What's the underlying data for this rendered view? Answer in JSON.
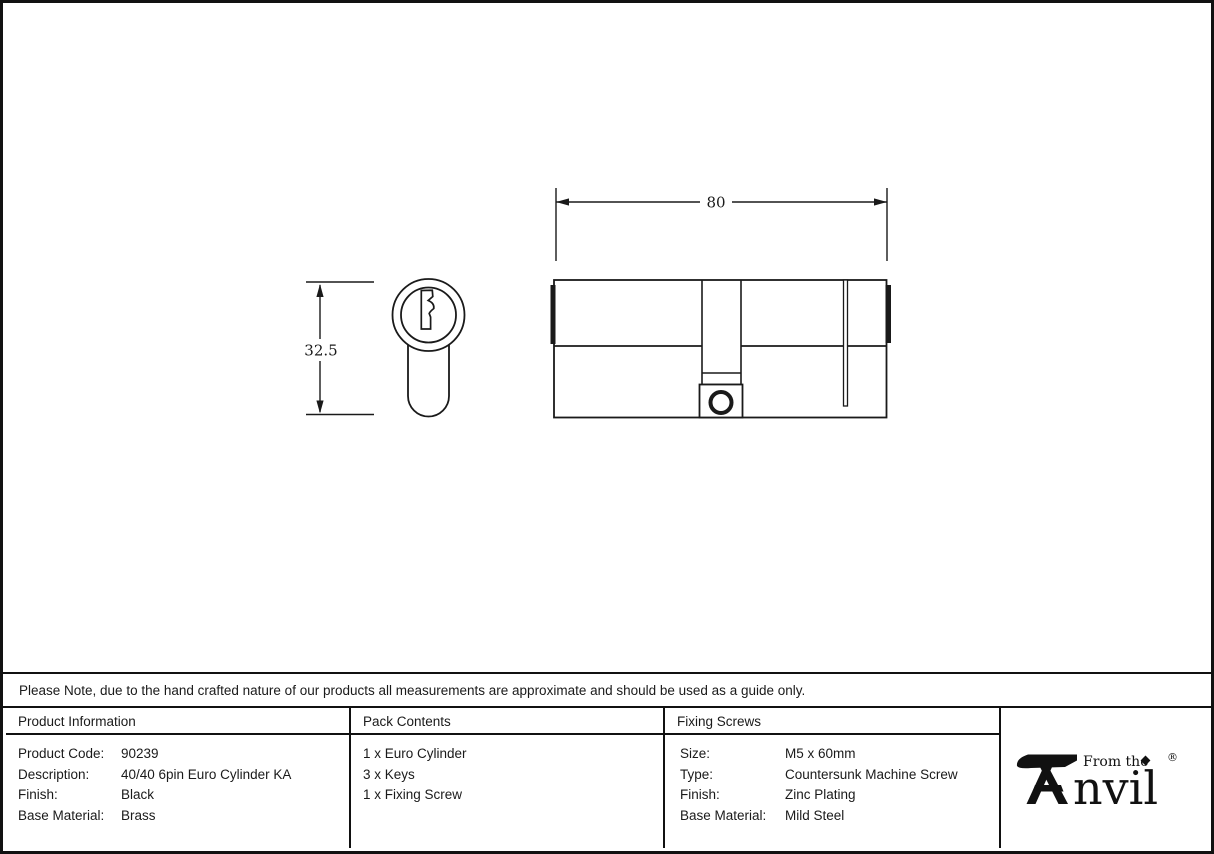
{
  "sheet": {
    "background": "#ffffff",
    "border_color": "#111111",
    "ink_color": "#1a1a1a"
  },
  "drawing": {
    "type": "technical-drawing",
    "subject": "euro-cylinder-lock",
    "width_dim": {
      "label": "80"
    },
    "height_dim": {
      "label": "32.5"
    }
  },
  "note": {
    "text": "Please Note, due to the hand crafted nature of our products all measurements are approximate and should be used as a guide only."
  },
  "table": {
    "product_information": {
      "header": "Product Information",
      "rows": [
        {
          "label": "Product Code:",
          "value": "90239"
        },
        {
          "label": "Description:",
          "value": "40/40 6pin Euro Cylinder KA"
        },
        {
          "label": "Finish:",
          "value": "Black"
        },
        {
          "label": "Base Material:",
          "value": "Brass"
        }
      ]
    },
    "pack_contents": {
      "header": "Pack Contents",
      "items": [
        "1 x Euro Cylinder",
        "3 x Keys",
        "1 x Fixing Screw"
      ]
    },
    "fixing_screws": {
      "header": "Fixing Screws",
      "rows": [
        {
          "label": "Size:",
          "value": "M5 x 60mm"
        },
        {
          "label": "Type:",
          "value": "Countersunk Machine Screw"
        },
        {
          "label": "Finish:",
          "value": "Zinc Plating"
        },
        {
          "label": "Base Material:",
          "value": "Mild Steel"
        }
      ]
    }
  },
  "logo": {
    "prefix": "From the",
    "brand": "Anvil",
    "brand_suffix": "nvil",
    "registered": "®"
  }
}
